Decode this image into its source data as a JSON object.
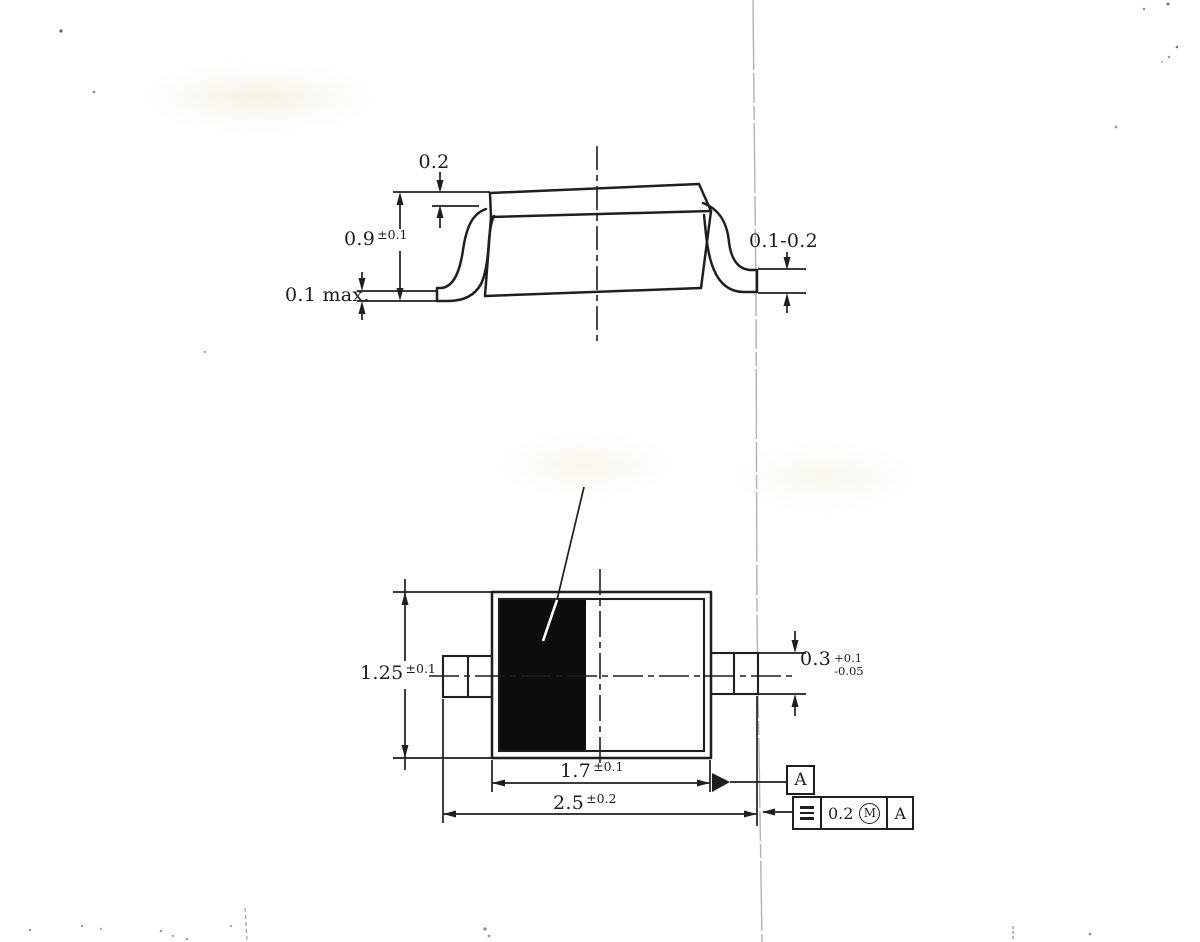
{
  "side_view": {
    "dim_step": {
      "value": "0.2"
    },
    "dim_body_height": {
      "value": "0.9",
      "tol": "±0.1"
    },
    "dim_standoff": {
      "value": "0.1 max."
    },
    "dim_lead_thickness": {
      "value": "0.1-0.2"
    }
  },
  "top_view": {
    "dim_body_width": {
      "value": "1.25",
      "tol": "±0.1"
    },
    "dim_lead_width": {
      "value": "0.3",
      "tol_plus": "+0.1",
      "tol_minus": "-0.05"
    },
    "dim_body_length": {
      "value": "1.7",
      "tol": "±0.1"
    },
    "dim_total_length": {
      "value": "2.5",
      "tol": "±0.2"
    },
    "datum_flag": "A"
  },
  "feature_control_frame": {
    "symbol": "symmetry",
    "tolerance": "0.2",
    "modifier": "M",
    "datum": "A"
  },
  "colors": {
    "line": "#1f1f1f",
    "fill_black": "#0d0d0d",
    "fold_line": "#b2b2b2"
  }
}
